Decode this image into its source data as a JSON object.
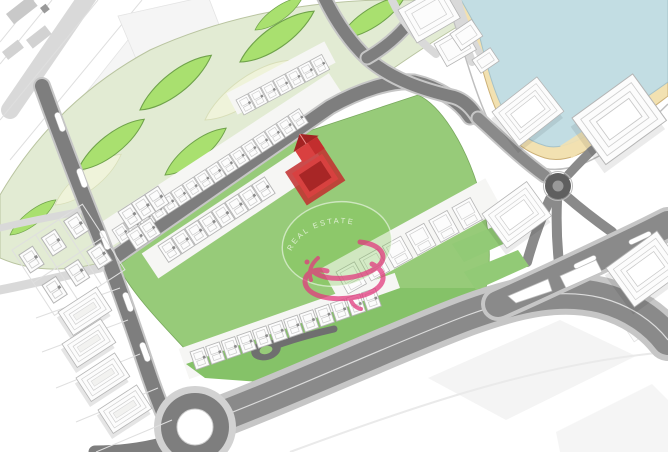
{
  "image": {
    "kind": "3d-masterplan-site-map",
    "width": 668,
    "height": 452
  },
  "colors": {
    "background": "#ffffff",
    "road_dark": "#7e7e7e",
    "road_mid": "#8a8a8a",
    "road_light": "#d9d9d9",
    "curb": "#c6c6c6",
    "park_base": "#e2ebd3",
    "park_edge": "#b9c4a0",
    "park_cream": "#eff3da",
    "leaf_green": "#a9e06f",
    "leaf_outline": "#6fa24a",
    "lawn_green": "#97cb79",
    "lawn_strip": "#85c268",
    "block_edge": "#79a95e",
    "building_white": "#fcfcfc",
    "building_stroke": "#b5b5b5",
    "roof_line": "#cfcfcf",
    "plot_line": "#dfdfdf",
    "white_band": "#f6f6f4",
    "highlight_red": "#d94040",
    "highlight_red_dark": "#a32323",
    "highlight_red_mid": "#c22e2e",
    "lake_blue": "#c2dde3",
    "lake_stroke": "#a6c2c8",
    "beach_sand": "#f2e1b1",
    "beach_stroke": "#ccb077",
    "watermark_green": "#76c24a",
    "watermark_ring": "#ffffff",
    "watermark_pink": "#e23a7e",
    "watermark_text_color": "#f4f9ee"
  },
  "watermark": {
    "arc_text": "REAL ESTATE",
    "logo_icon": "pink-swirl-s-logo"
  },
  "features": {
    "lake": "lake-with-beach-promenade",
    "park": "curved-linear-park-with-leaf-lawns",
    "highlighted_unit": "red-highlighted-villa",
    "roundabout_large": "roundabout",
    "roundabout_small": "roundabout",
    "townhouse_rows": "white-townhouse-rows",
    "apartment_blocks": "white-apartment-blocks",
    "villa_plots": "white-villa-plots"
  }
}
